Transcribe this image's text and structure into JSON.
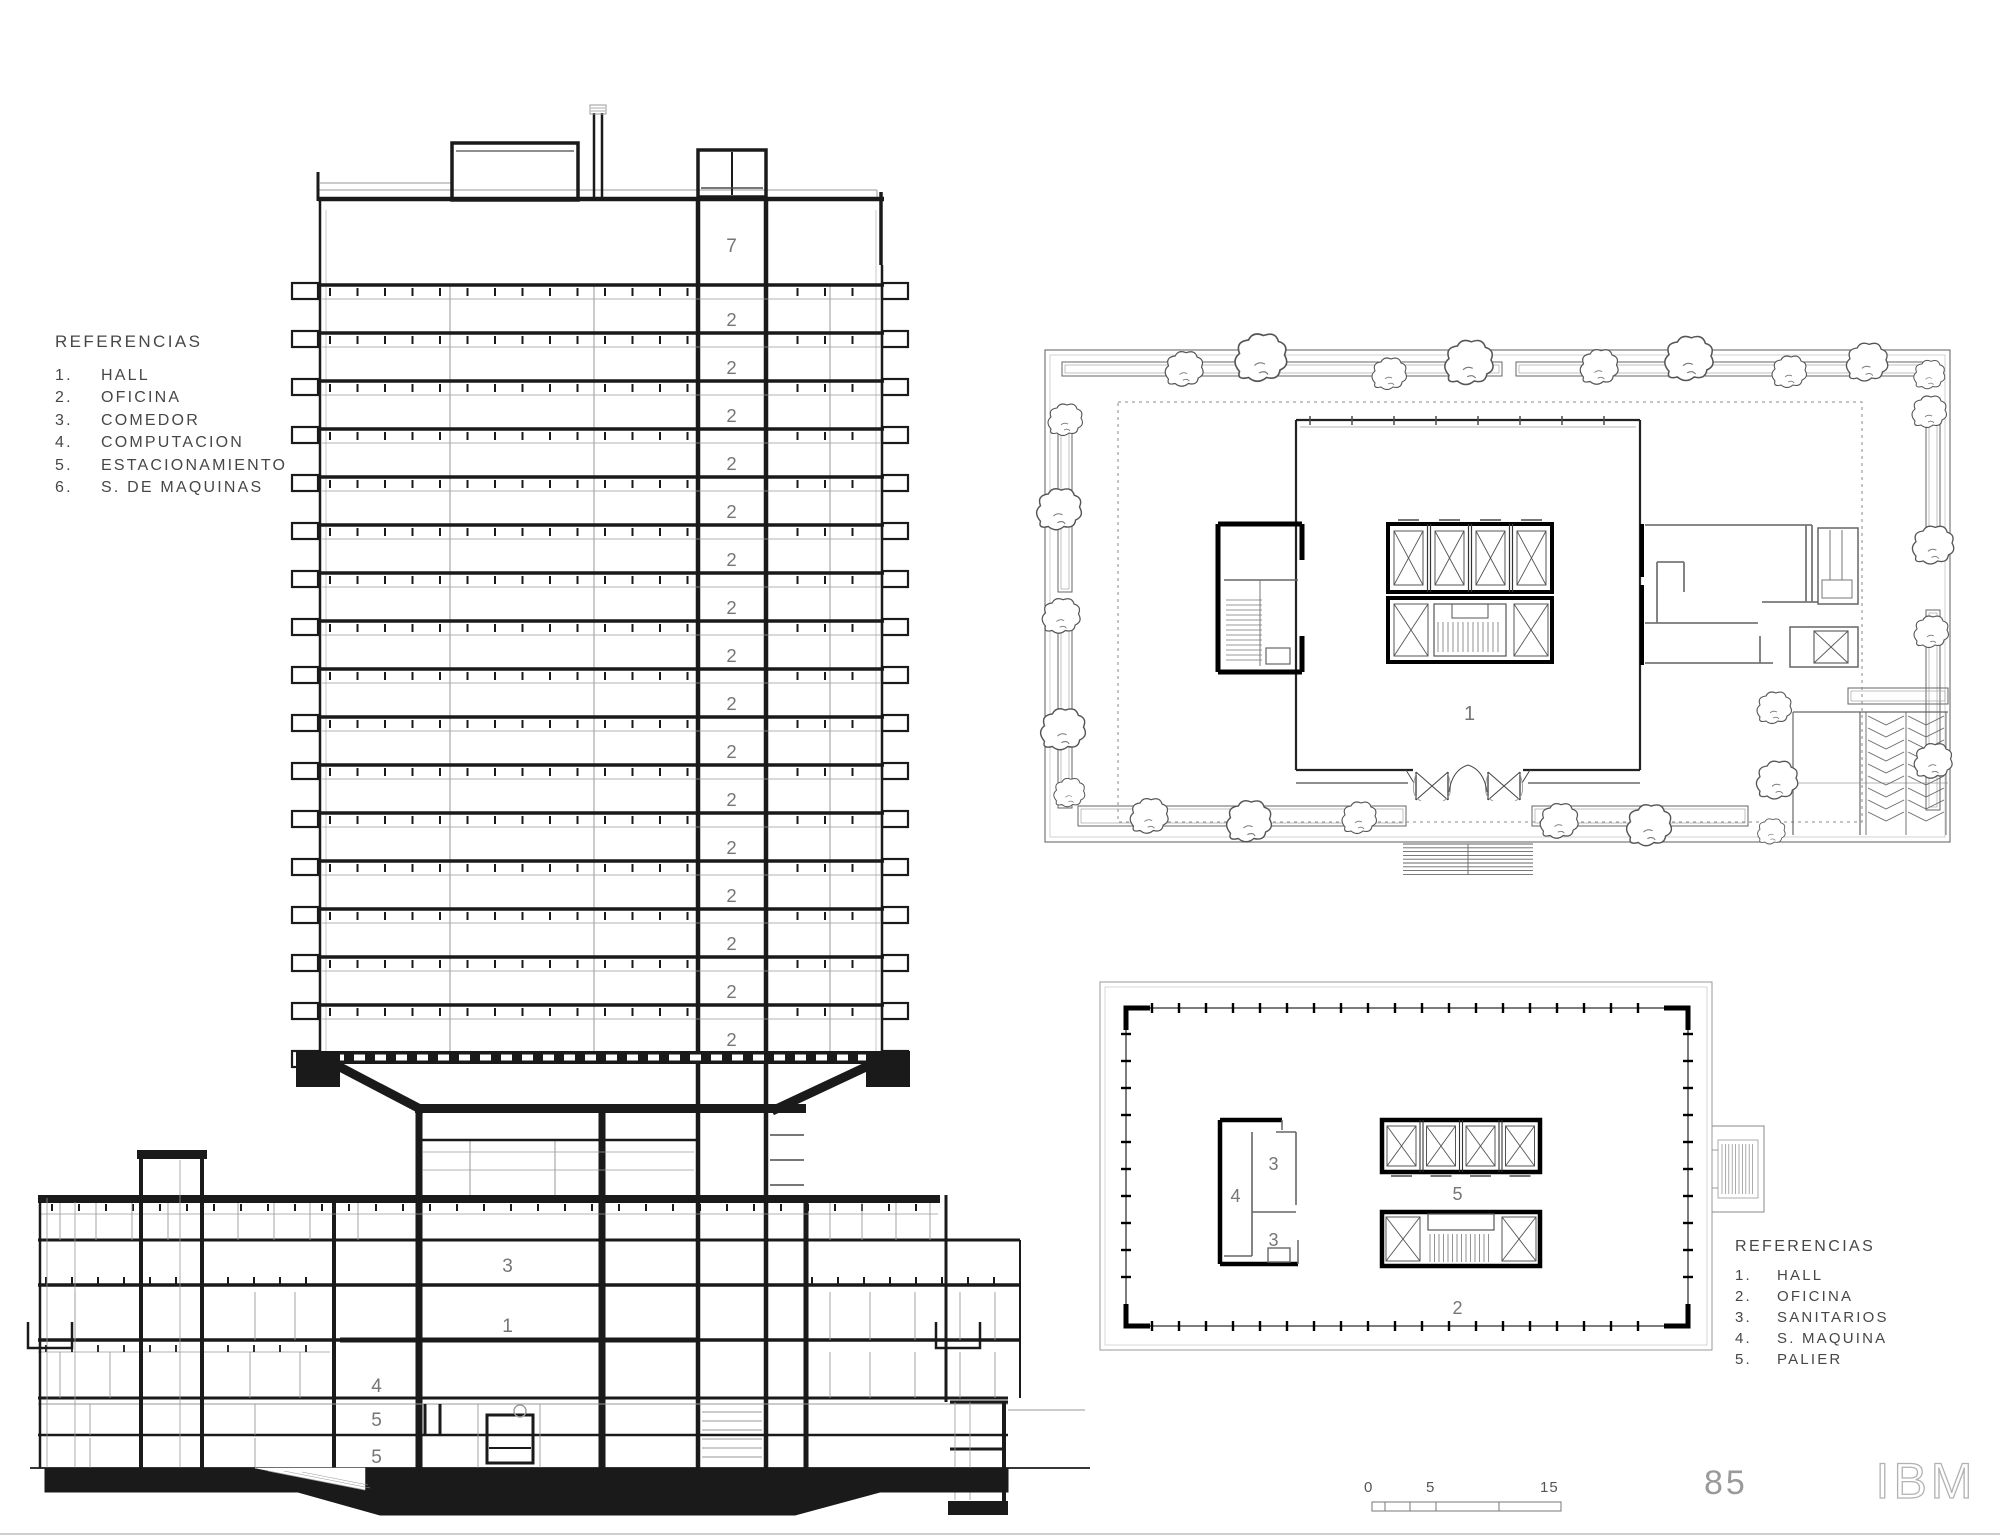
{
  "page": {
    "page_number": "85",
    "brand": "IBM"
  },
  "scale_bar": {
    "labels": [
      "0",
      "5",
      "15"
    ]
  },
  "legend_section": {
    "title": "REFERENCIAS",
    "items": [
      {
        "num": "1.",
        "label": "HALL"
      },
      {
        "num": "2.",
        "label": "OFICINA"
      },
      {
        "num": "3.",
        "label": "COMEDOR"
      },
      {
        "num": "4.",
        "label": "COMPUTACION"
      },
      {
        "num": "5.",
        "label": "ESTACIONAMIENTO"
      },
      {
        "num": "6.",
        "label": "S. DE MAQUINAS"
      }
    ]
  },
  "legend_plan": {
    "title": "REFERENCIAS",
    "items": [
      {
        "num": "1.",
        "label": "HALL"
      },
      {
        "num": "2.",
        "label": "OFICINA"
      },
      {
        "num": "3.",
        "label": "SANITARIOS"
      },
      {
        "num": "4.",
        "label": "S. MAQUINA"
      },
      {
        "num": "5.",
        "label": "PALIER"
      }
    ]
  },
  "section": {
    "tower": {
      "top_floor_label": "7",
      "office_floor_label": "2",
      "office_floor_count": 16
    },
    "podium": {
      "comedor": "3",
      "hall": "1",
      "computacion": "4",
      "parking_upper": "5",
      "parking_lower": "5"
    }
  },
  "ground_floor_plan": {
    "hall": "1"
  },
  "typical_floor_plan": {
    "machine": "4",
    "sanitary_upper": "3",
    "sanitary_lower": "3",
    "palier": "5",
    "office": "2"
  }
}
